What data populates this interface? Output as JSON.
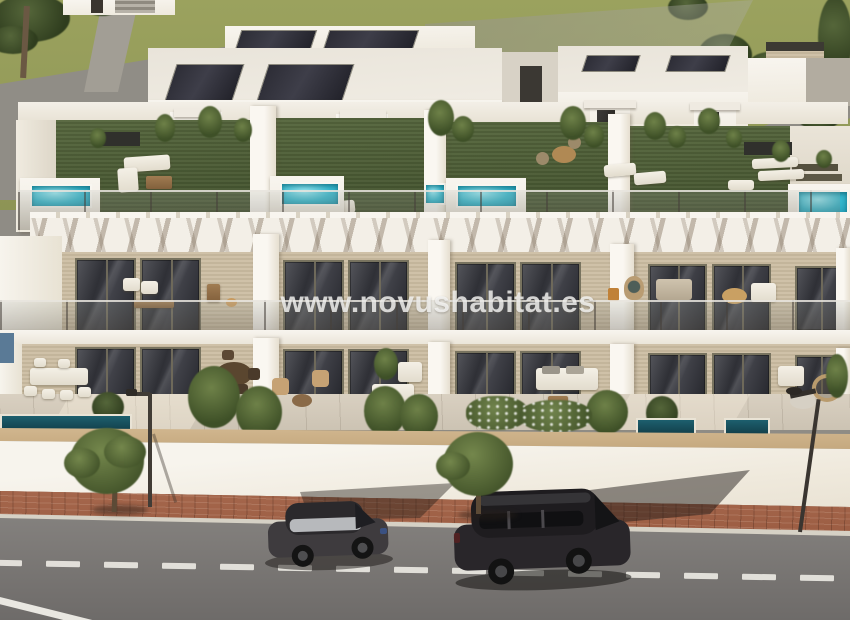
{
  "watermark": {
    "text": "www.novushabitat.es"
  },
  "palette": {
    "field_green": "#99a05e",
    "roof_grass_green": "#4c5d39",
    "pool_turquoise": "#35b6cc",
    "plunge_pool_teal": "#1d5f6e",
    "facade_white": "#f6f3ec",
    "wood_cladding": "#c9bba1",
    "window_glass_dark": "#323238",
    "coping_wood": "#c9ac85",
    "sidewalk_brick": "#a3654b",
    "curb_concrete": "#d6d1c6",
    "asphalt_gray": "#7b7876",
    "road_marking_white": "#e9e7e1",
    "car_dark": "#2a272a",
    "tree_green": "#5c6f3d",
    "solar_panel_dark": "#2c2c34"
  },
  "scene": {
    "kind": "3d-architectural-render",
    "subject": "row of modern townhouses with rooftop garden terraces and plunge pools",
    "objects": [
      "solar-panels",
      "rooftop-lawns",
      "rooftop-pools",
      "stair-bulkheads",
      "pergola-shadows",
      "glass-balustrades",
      "balconies",
      "ground-terraces",
      "boundary-wall",
      "brick-sidewalk",
      "street-trees",
      "street-lamps",
      "asphalt-road",
      "lane-dashes",
      "parked-hatchback",
      "parked-suv"
    ]
  }
}
